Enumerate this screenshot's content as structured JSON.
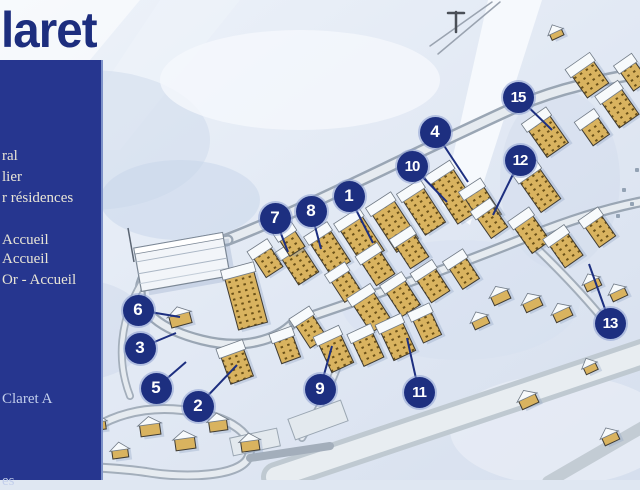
{
  "title": {
    "text": "laret"
  },
  "sidebar": {
    "items": [
      {
        "id": "general",
        "label": "ral",
        "top": 88,
        "bluish": false
      },
      {
        "id": "lier",
        "label": "lier",
        "top": 109,
        "bluish": false
      },
      {
        "id": "residences",
        "label": "r résidences",
        "top": 130,
        "bluish": false
      },
      {
        "id": "accueil-1",
        "label": "Accueil",
        "top": 172,
        "bluish": false
      },
      {
        "id": "accueil-2",
        "label": "Accueil",
        "top": 191,
        "bluish": false
      },
      {
        "id": "or-accueil",
        "label": "Or - Accueil",
        "top": 212,
        "bluish": false
      },
      {
        "id": "claret-a",
        "label": "Claret A",
        "top": 331,
        "bluish": true
      },
      {
        "id": "es",
        "label": "es",
        "top": 413,
        "bluish": true
      }
    ]
  },
  "map": {
    "markers": [
      {
        "n": "1",
        "x": 349,
        "y": 196,
        "lx": 373,
        "ly": 243
      },
      {
        "n": "2",
        "x": 198,
        "y": 406,
        "lx": 237,
        "ly": 365
      },
      {
        "n": "3",
        "x": 140,
        "y": 348,
        "lx": 176,
        "ly": 333
      },
      {
        "n": "4",
        "x": 435,
        "y": 132,
        "lx": 468,
        "ly": 182
      },
      {
        "n": "5",
        "x": 156,
        "y": 388,
        "lx": 186,
        "ly": 362
      },
      {
        "n": "6",
        "x": 138,
        "y": 310,
        "lx": 180,
        "ly": 317
      },
      {
        "n": "7",
        "x": 275,
        "y": 218,
        "lx": 288,
        "ly": 252
      },
      {
        "n": "8",
        "x": 311,
        "y": 211,
        "lx": 321,
        "ly": 249
      },
      {
        "n": "9",
        "x": 320,
        "y": 389,
        "lx": 332,
        "ly": 346
      },
      {
        "n": "10",
        "x": 412,
        "y": 166,
        "lx": 447,
        "ly": 202
      },
      {
        "n": "11",
        "x": 419,
        "y": 392,
        "lx": 407,
        "ly": 338
      },
      {
        "n": "12",
        "x": 520,
        "y": 160,
        "lx": 493,
        "ly": 215
      },
      {
        "n": "13",
        "x": 610,
        "y": 323,
        "lx": 589,
        "ly": 264
      },
      {
        "n": "15",
        "x": 518,
        "y": 97,
        "lx": 552,
        "ly": 130
      }
    ],
    "buildings": [
      [
        300,
        265,
        24,
        32,
        -33,
        "t"
      ],
      [
        330,
        252,
        24,
        38,
        -33,
        "t"
      ],
      [
        362,
        240,
        26,
        42,
        -33,
        "t"
      ],
      [
        395,
        226,
        26,
        46,
        -33,
        "t"
      ],
      [
        424,
        211,
        24,
        42,
        -33,
        "t"
      ],
      [
        455,
        196,
        26,
        50,
        -33,
        "t"
      ],
      [
        483,
        206,
        22,
        34,
        -33,
        "t"
      ],
      [
        412,
        251,
        22,
        28,
        -33,
        "t"
      ],
      [
        378,
        268,
        22,
        28,
        -33,
        "t"
      ],
      [
        346,
        286,
        20,
        26,
        -33,
        "t"
      ],
      [
        372,
        312,
        24,
        34,
        -33,
        "t"
      ],
      [
        403,
        298,
        22,
        30,
        -33,
        "t"
      ],
      [
        433,
        285,
        22,
        28,
        -33,
        "t"
      ],
      [
        464,
        273,
        20,
        26,
        -33,
        "t"
      ],
      [
        311,
        331,
        20,
        28,
        -33,
        "t"
      ],
      [
        336,
        353,
        24,
        32,
        -25,
        "t"
      ],
      [
        368,
        349,
        22,
        28,
        -25,
        "t"
      ],
      [
        398,
        341,
        24,
        32,
        -25,
        "t"
      ],
      [
        427,
        327,
        20,
        26,
        -25,
        "t"
      ],
      [
        246,
        300,
        30,
        54,
        -15,
        "t"
      ],
      [
        237,
        366,
        24,
        30,
        -20,
        "t"
      ],
      [
        287,
        349,
        20,
        24,
        -20,
        "t"
      ],
      [
        268,
        262,
        20,
        24,
        -33,
        "t"
      ],
      [
        292,
        243,
        18,
        20,
        -33,
        "t"
      ],
      [
        548,
        136,
        26,
        34,
        -35,
        "t"
      ],
      [
        540,
        190,
        24,
        38,
        -35,
        "t"
      ],
      [
        532,
        234,
        22,
        32,
        -35,
        "t"
      ],
      [
        566,
        250,
        22,
        28,
        -35,
        "t"
      ],
      [
        600,
        231,
        20,
        26,
        -35,
        "t"
      ],
      [
        590,
        79,
        26,
        28,
        -35,
        "t"
      ],
      [
        620,
        108,
        24,
        32,
        -35,
        "t"
      ],
      [
        595,
        131,
        20,
        22,
        -35,
        "t"
      ],
      [
        634,
        76,
        18,
        24,
        -35,
        "t"
      ],
      [
        492,
        222,
        20,
        26,
        -35,
        "t"
      ],
      [
        180,
        318,
        21,
        15,
        -15,
        "c"
      ],
      [
        500,
        296,
        18,
        13,
        -25,
        "c"
      ],
      [
        532,
        303,
        18,
        13,
        -25,
        "c"
      ],
      [
        562,
        313,
        18,
        13,
        -25,
        "c"
      ],
      [
        592,
        283,
        16,
        12,
        -25,
        "c"
      ],
      [
        618,
        293,
        16,
        12,
        -25,
        "c"
      ],
      [
        480,
        321,
        16,
        12,
        -25,
        "c"
      ],
      [
        150,
        428,
        20,
        15,
        -8,
        "c"
      ],
      [
        185,
        442,
        20,
        15,
        -8,
        "c"
      ],
      [
        218,
        424,
        18,
        14,
        -8,
        "c"
      ],
      [
        250,
        444,
        18,
        14,
        -8,
        "c"
      ],
      [
        120,
        452,
        16,
        12,
        -8,
        "c"
      ],
      [
        98,
        424,
        15,
        12,
        -8,
        "c"
      ],
      [
        528,
        400,
        18,
        13,
        -25,
        "c"
      ],
      [
        610,
        437,
        16,
        12,
        -25,
        "c"
      ],
      [
        590,
        367,
        13,
        11,
        -25,
        "c"
      ],
      [
        556,
        33,
        13,
        10,
        -25,
        "c"
      ]
    ]
  },
  "colors": {
    "sidebar_bg": "#26368f",
    "sidebar_text": "#e9e5d6",
    "title_text": "#1d2e7e",
    "marker_bg": "#1d2f80",
    "marker_text": "#ffffff",
    "building_wall": "#d9b35f",
    "road_edge": "#9aa6b4",
    "road_fill": "#e6ebf0",
    "snow_bg": "#dfe7f2"
  }
}
